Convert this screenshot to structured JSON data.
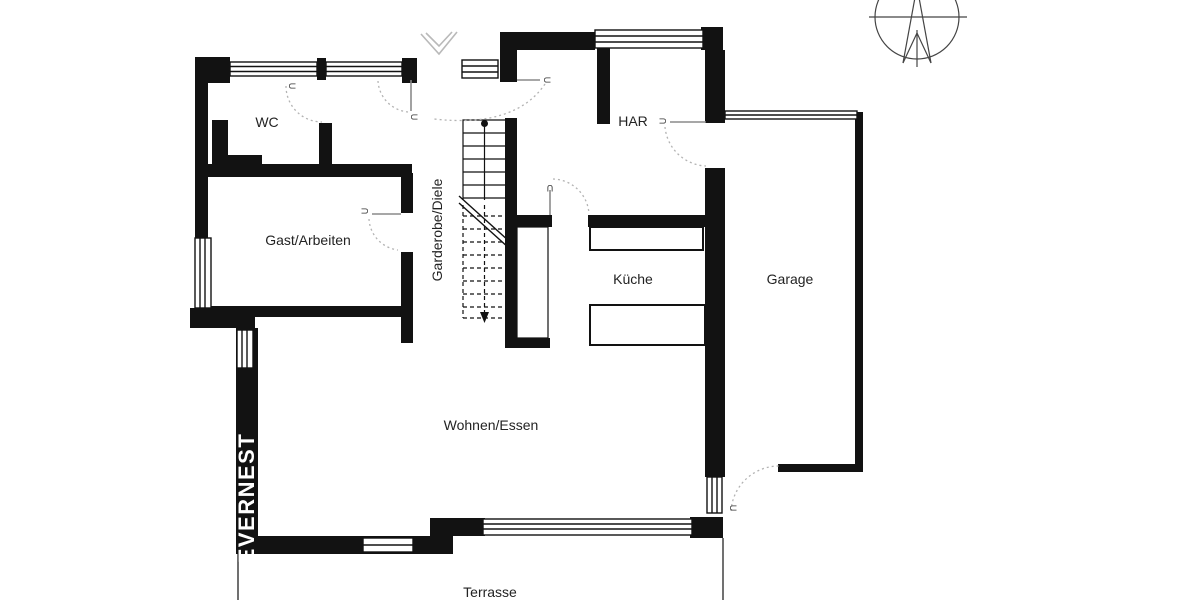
{
  "title": "Grundriss Erdgeschoss",
  "watermark": "EVERNEST",
  "door_symbol": "U",
  "rooms": {
    "wc": {
      "label": "WC"
    },
    "gast": {
      "label": "Gast/Arbeiten"
    },
    "garderobe": {
      "label": "Garderobe/Diele"
    },
    "har": {
      "label": "HAR"
    },
    "kueche": {
      "label": "Küche"
    },
    "garage": {
      "label": "Garage"
    },
    "wohnen": {
      "label": "Wohnen/Essen"
    },
    "terrasse": {
      "label": "Terrasse"
    }
  },
  "colors": {
    "background": "#ffffff",
    "wall": "#121212",
    "door_arc": "#b3b3b3",
    "label_text": "#232323",
    "watermark_text": "#ffffff",
    "compass_line": "#444444"
  }
}
